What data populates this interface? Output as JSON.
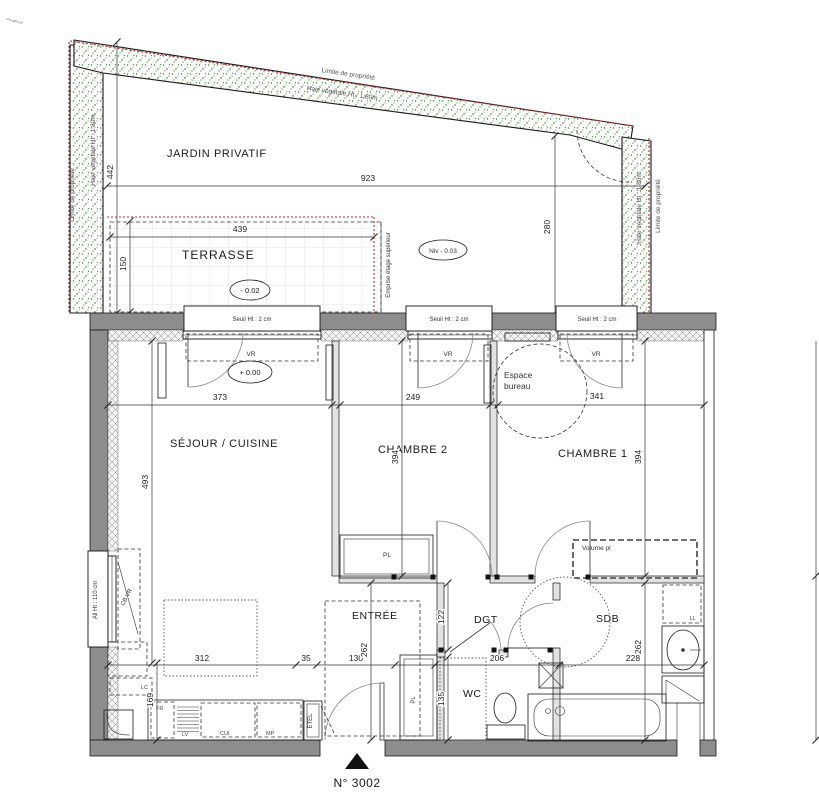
{
  "colors": {
    "boundary_red": "#c62828",
    "hedge_green": "#3f7d3f",
    "wall_gray": "#8d8d8d"
  },
  "garden": {
    "name": "JARDIN PRIVATIF",
    "limit": "Limite de propriété",
    "hedge": "Haie végétale Ht : 1,80m",
    "d_width": "923",
    "d_left": "442",
    "d_right": "280",
    "level": "Niv - 0.03"
  },
  "terrace": {
    "name": "TERRASSE",
    "d_width": "439",
    "d_depth": "150",
    "level": "- 0.02",
    "upper": "Emprise étage supérieur"
  },
  "win": {
    "sill": "Seuil Ht : 2 cm",
    "vr": "VR",
    "left_sill": "All Ht : 110 cm",
    "left_vr": "CB VR"
  },
  "rooms": {
    "living": "SÉJOUR / CUISINE",
    "living_level": "+ 0.00",
    "bed2": "CHAMBRE 2",
    "bed1": "CHAMBRE 1",
    "desk_line1": "Espace",
    "desk_line2": "bureau",
    "entry": "ENTRÉE",
    "hall": "DGT",
    "wc": "WC",
    "bath": "SDB"
  },
  "fix": {
    "pl": "PL",
    "volume": "Volume pl",
    "ll": "LL",
    "lc": "LC",
    "fr": "FR",
    "lv": "LV",
    "cui": "CUI",
    "mp": "MP",
    "etel": "ETEL"
  },
  "dims": {
    "d373": "373",
    "d249": "249",
    "d341": "341",
    "d493": "493",
    "d394": "394",
    "d312": "312",
    "d35": "35",
    "d130": "130",
    "d262": "262",
    "d206": "206",
    "d228": "228",
    "d122": "122",
    "d135": "135",
    "d169": "169"
  },
  "unit": {
    "number": "N° 3002"
  }
}
